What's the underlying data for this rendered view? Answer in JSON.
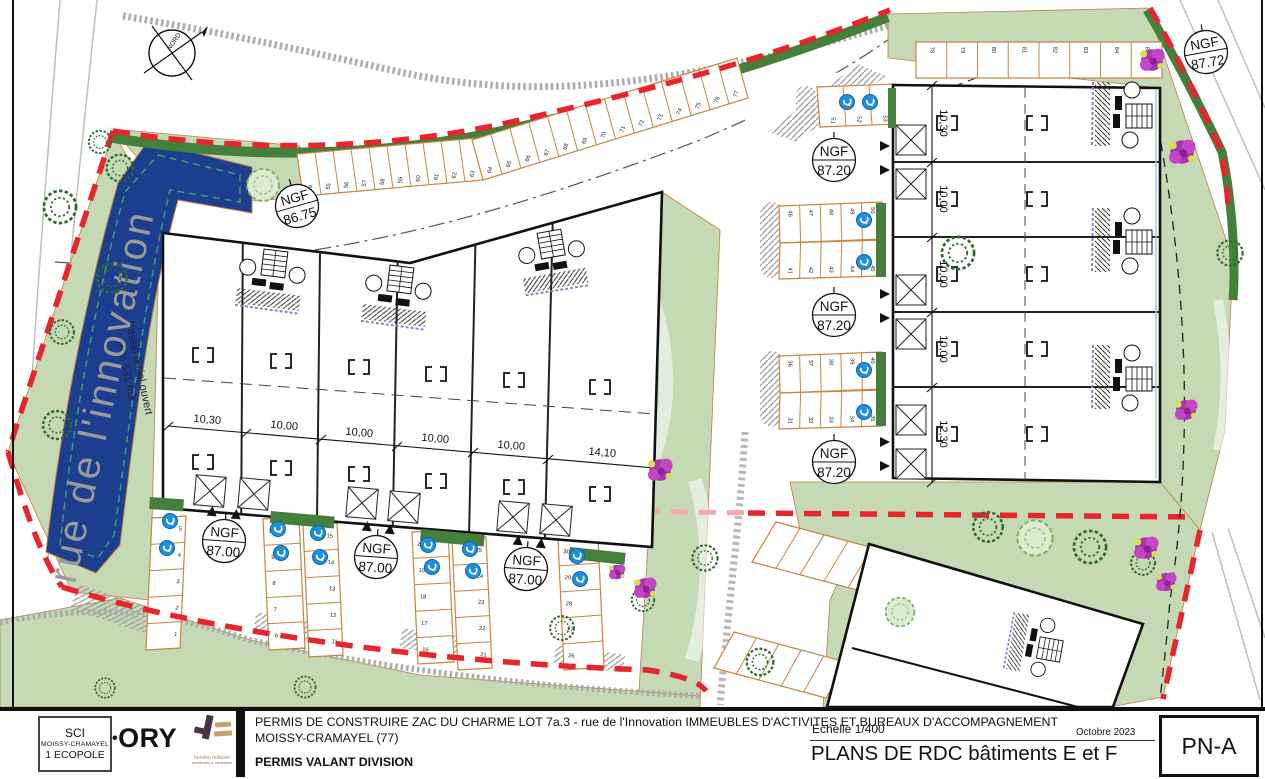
{
  "colors": {
    "boundary_red": "#e8242c",
    "parking_orange": "#c98440",
    "basin_blue": "#1d3e8e",
    "green_light": "#c5d9b4",
    "green_dark": "#447f3c",
    "ev_blue": "#1e90e0"
  },
  "plan": {
    "street_name": "rue de l'innovation",
    "compass_label": "NORD",
    "basin_label_line1": "Bassin à ciel ouvert",
    "basin_label_line2": "env. 531 m3",
    "ngf_markers": [
      {
        "label": "NGF",
        "value": "86.75"
      },
      {
        "label": "NGF",
        "value": "87.00"
      },
      {
        "label": "NGF",
        "value": "87.00"
      },
      {
        "label": "NGF",
        "value": "87.00"
      },
      {
        "label": "NGF",
        "value": "87.20"
      },
      {
        "label": "NGF",
        "value": "87.20"
      },
      {
        "label": "NGF",
        "value": "87.20"
      },
      {
        "label": "NGF",
        "value": "87.72"
      }
    ],
    "building_e": {
      "dims": [
        "10,30",
        "10,00",
        "10,00",
        "10,00",
        "10,00",
        "14,10"
      ]
    },
    "building_f": {
      "dims": [
        "10,30",
        "10,00",
        "10,00",
        "10,00",
        "12,30"
      ]
    },
    "parking": {
      "gA1": [
        "54",
        "55",
        "56",
        "57",
        "58",
        "59",
        "60",
        "61",
        "62",
        "63"
      ],
      "gA2": [
        "64",
        "65",
        "66",
        "67",
        "68",
        "69",
        "70",
        "71",
        "72",
        "73",
        "74",
        "75",
        "76",
        "77"
      ],
      "gB": [
        "78",
        "79",
        "80",
        "81",
        "82",
        "83",
        "84",
        "85"
      ],
      "gC": [
        "51",
        "52",
        "53"
      ],
      "gD_top": [
        "46",
        "47",
        "48",
        "49",
        "50"
      ],
      "gD_bottom": [
        "41",
        "42",
        "43",
        "44",
        "45"
      ],
      "gE_top": [
        "36",
        "37",
        "38",
        "39",
        "40"
      ],
      "gE_bottom": [
        "31",
        "32",
        "33",
        "34",
        "35"
      ],
      "gF1": [
        "5",
        "4",
        "3",
        "2",
        "1"
      ],
      "gF2_left": [
        "10",
        "9",
        "8",
        "7",
        "6"
      ],
      "gF2_right": [
        "15",
        "14",
        "13",
        "12",
        "11"
      ],
      "gF3_left": [
        "20",
        "19",
        "18",
        "17",
        "16"
      ],
      "gF3_right": [
        "25",
        "24",
        "23",
        "22",
        "21"
      ],
      "gF4": [
        "30",
        "29",
        "28",
        "27",
        "26"
      ],
      "gH1": [
        "",
        "",
        "",
        "",
        ""
      ],
      "gH2": [
        "",
        "",
        "",
        "",
        ""
      ]
    }
  },
  "title_block": {
    "client_box": {
      "line1": "SCI",
      "line2": "MOISSY-CRAMAYEL",
      "line3": "1 ECOPOLE"
    },
    "ory_dot": "•",
    "ory_logo": "ORY",
    "hf_line1": "hervieu fellacier",
    "hf_line2": "architectes & urbanistes",
    "project_line1": "PERMIS DE CONSTRUIRE ZAC DU CHARME LOT 7a.3 - rue de l'Innovation IMMEUBLES D'ACTIVITES ET BUREAUX D'ACCOMPAGNEMENT",
    "project_line2": "MOISSY-CRAMAYEL (77)",
    "permit_type": "PERMIS VALANT DIVISION",
    "scale_label": "Echelle 1/400",
    "date": "Octobre 2023",
    "drawing_title": "PLANS DE RDC bâtiments E et F",
    "sheet_number": "PN-A"
  }
}
